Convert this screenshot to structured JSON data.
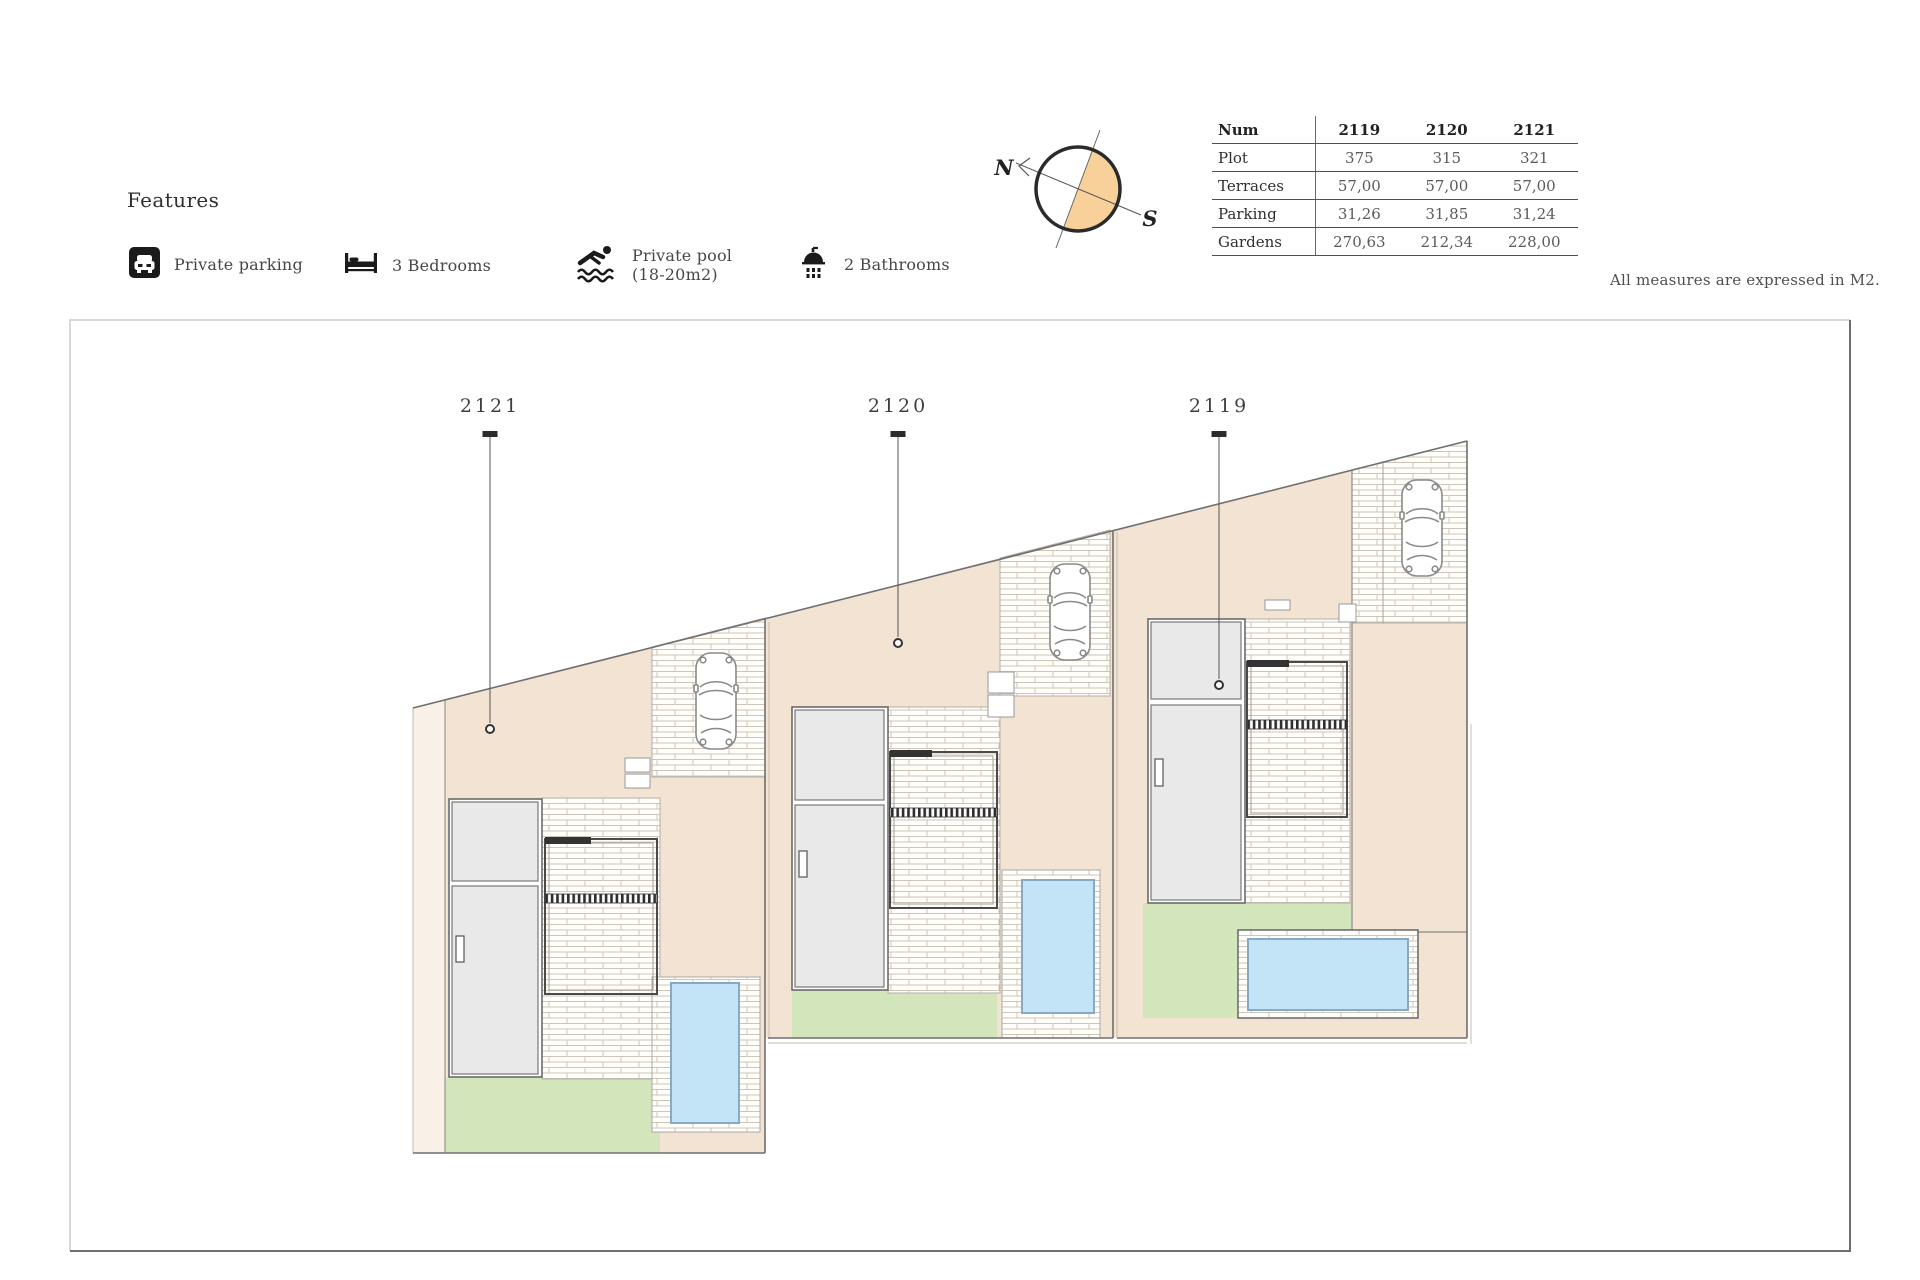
{
  "features": {
    "title": "Features",
    "items": [
      {
        "icon": "parking-icon",
        "label": "Private parking"
      },
      {
        "icon": "bed-icon",
        "label": "3 Bedrooms"
      },
      {
        "icon": "pool-icon",
        "label": "Private pool",
        "label2": "(18-20m2)"
      },
      {
        "icon": "shower-icon",
        "label": "2 Bathrooms"
      }
    ]
  },
  "compass": {
    "north": "N",
    "south": "S",
    "fill_color": "#f8d09a"
  },
  "table": {
    "header": [
      "Num",
      "2119",
      "2120",
      "2121"
    ],
    "rows": [
      {
        "label": "Plot",
        "values": [
          "375",
          "315",
          "321"
        ]
      },
      {
        "label": "Terraces",
        "values": [
          "57,00",
          "57,00",
          "57,00"
        ]
      },
      {
        "label": "Parking",
        "values": [
          "31,26",
          "31,85",
          "31,24"
        ]
      },
      {
        "label": "Gardens",
        "values": [
          "270,63",
          "212,34",
          "228,00"
        ]
      }
    ]
  },
  "note": "All measures are expressed in M2.",
  "plan": {
    "plots": [
      {
        "label": "2121"
      },
      {
        "label": "2120"
      },
      {
        "label": "2119"
      }
    ]
  },
  "colors": {
    "beige": "#f3e3d3",
    "beige_light": "#f9f0e7",
    "garden_green": "#d3e5ba",
    "pool_blue": "#c3e3f7",
    "compass_orange": "#f8d09a",
    "building_grey": "#e9e9e9"
  }
}
